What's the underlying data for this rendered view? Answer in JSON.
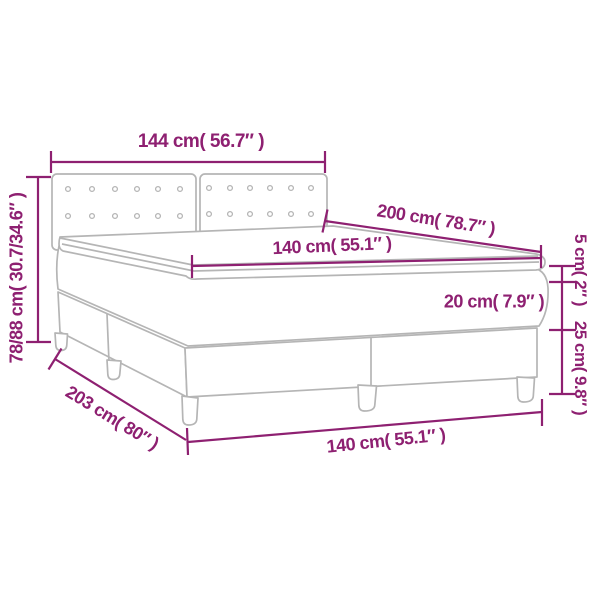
{
  "diagram": {
    "type": "product-dimension-diagram",
    "subject": "box-spring-bed-with-tufted-headboard-mattress-and-topper",
    "accent_color": "#8e2071",
    "artwork_color": "#b5b5b5",
    "background_color": "#ffffff",
    "dimensions": {
      "headboard_width": "144 cm( 56.7″ )",
      "height_range": "78/88 cm( 30.7/34.6″ )",
      "mattress_length": "200 cm( 78.7″ )",
      "mattress_width_top": "140 cm( 55.1″ )",
      "topper_height": "5 cm( 2″ )",
      "mattress_height": "20 cm( 7.9″ )",
      "base_height": "25 cm( 9.8″ )",
      "total_length": "203 cm( 80″ )",
      "base_width_bottom": "140 cm( 55.1″ )"
    }
  }
}
